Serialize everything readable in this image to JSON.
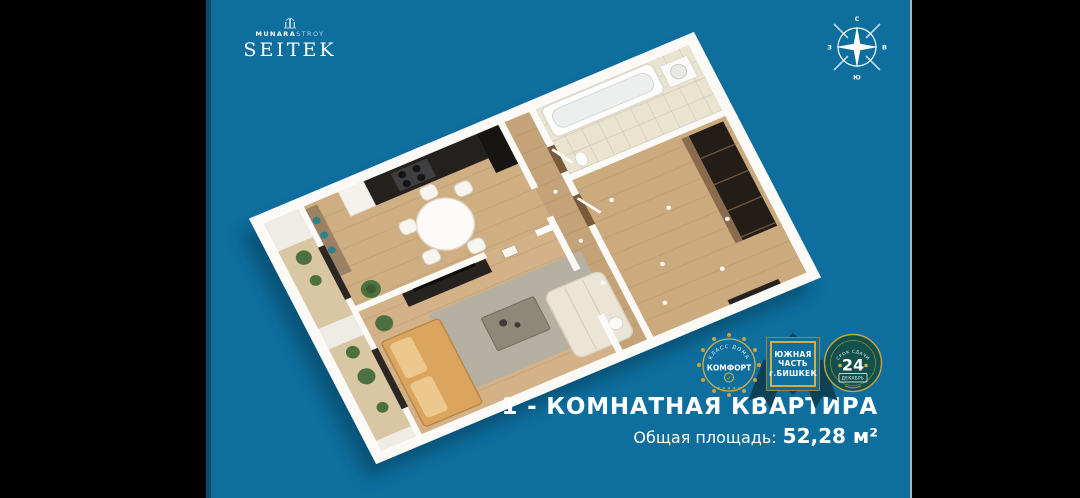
{
  "colors": {
    "background_teal": "#0e6f9e",
    "edge_dark_strip": "#0b4a70",
    "side_bars": "#000000",
    "gold_accent": "#c9a43c",
    "ribbon_dark": "#0d4156",
    "wall_white": "#f6f4ef",
    "wood_floor": "#cfae82"
  },
  "logo": {
    "line1_strong": "MUNARA",
    "line1_light": "STROY",
    "line2": "SEITEK"
  },
  "compass": {
    "n": "С",
    "e": "В",
    "s": "Ю",
    "w": "З"
  },
  "floorplan": {
    "kind": "3d-render-floor-plan",
    "rooms": [
      "balcony",
      "kitchen-dining",
      "living-room",
      "hallway",
      "bathroom",
      "bedroom"
    ]
  },
  "badges": {
    "class": {
      "arc": "КЛАСС ДОМА",
      "label": "КОМФОРТ",
      "check": "✓",
      "stars": "★ ★ ★ ★ ★"
    },
    "location": {
      "line1": "ЮЖНАЯ",
      "line2": "ЧАСТЬ",
      "line3": "г.БИШКЕК"
    },
    "deadline": {
      "arc": "СРОК СДАЧИ",
      "value": "24",
      "sub": "ДЕКАБРЬ"
    }
  },
  "footer": {
    "title": "1 - КОМНАТНАЯ КВАРТИРА",
    "area_label": "Общая площадь:",
    "area_value": "52,28 м²"
  }
}
